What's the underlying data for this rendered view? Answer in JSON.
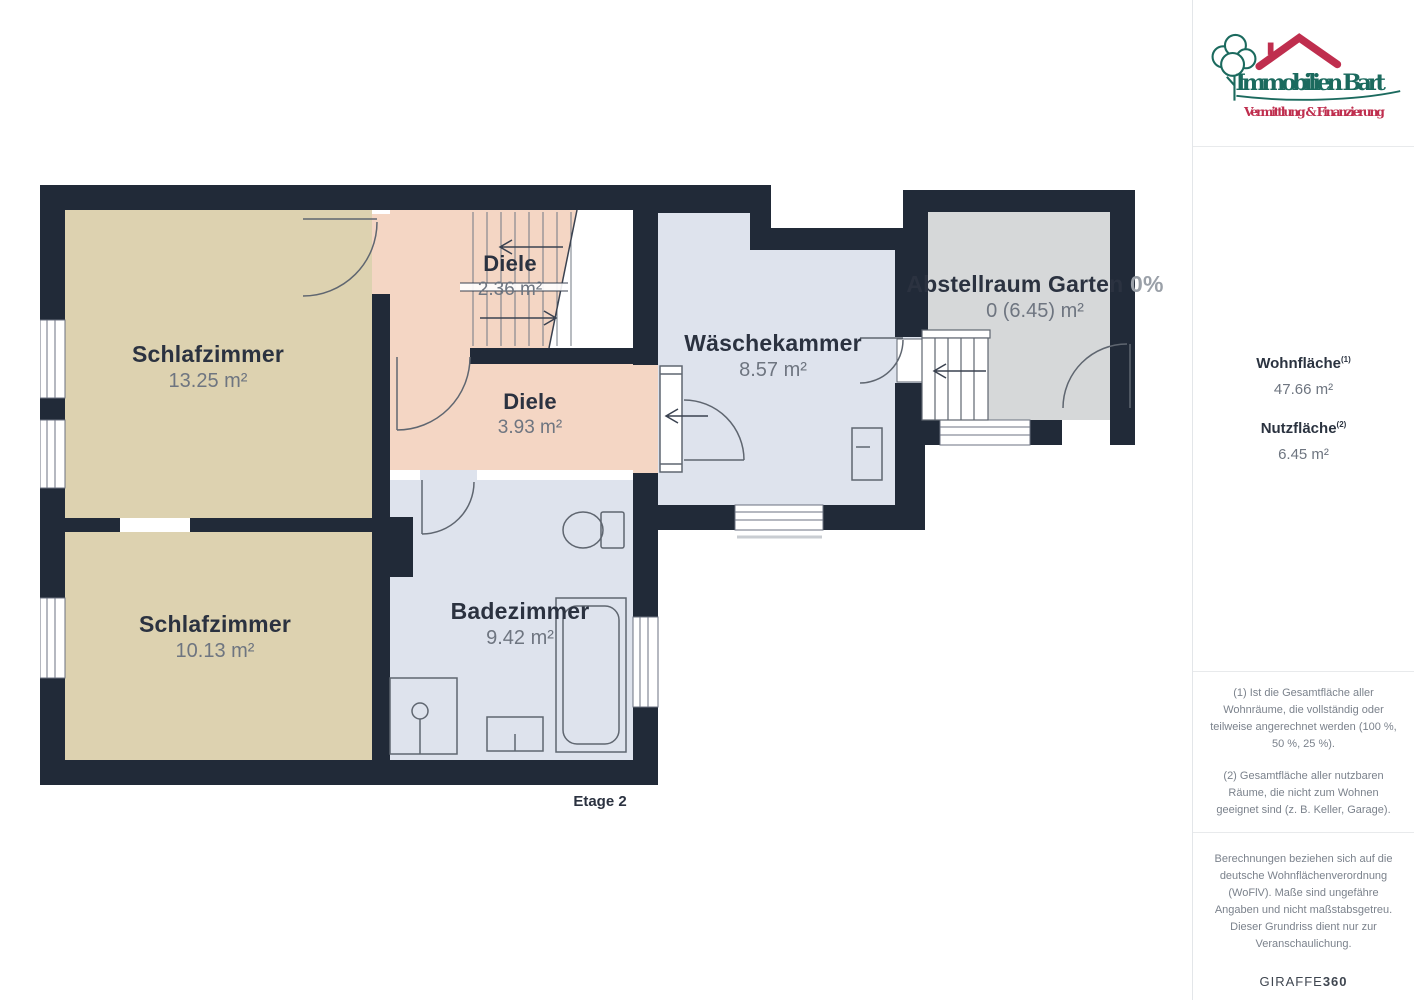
{
  "branding": {
    "title": "Immobilien Bart",
    "subtitle": "Vermittlung & Finanzierung",
    "title_color": "#1b6a5e",
    "subtitle_color": "#bf2e4e"
  },
  "sidebar": {
    "wohnflaeche_label": "Wohnfläche",
    "wohnflaeche_sup": "(1)",
    "wohnflaeche_value": "47.66 m²",
    "nutzflaeche_label": "Nutzfläche",
    "nutzflaeche_sup": "(2)",
    "nutzflaeche_value": "6.45 m²",
    "footnote_1": "(1) Ist die Gesamtfläche aller Wohnräume, die vollständig oder teilweise angerechnet werden (100 %, 50 %, 25 %).",
    "footnote_2": "(2) Gesamtfläche aller nutzbaren Räume, die nicht zum Wohnen geeignet sind (z. B. Keller, Garage).",
    "disclaimer": "Berechnungen beziehen sich auf die deutsche Wohnflächenverordnung (WoFlV). Maße sind ungefähre Angaben und nicht maßstabsgetreu. Dieser Grundriss dient nur zur Veranschaulichung.",
    "brand_name": "GIRAFFE",
    "brand_number": "360"
  },
  "floorplan": {
    "floor_label": "Etage 2",
    "rooms": {
      "schlafzimmer_1": {
        "name": "Schlafzimmer",
        "area": "13.25 m²"
      },
      "diele_1": {
        "name": "Diele",
        "area": "2.36 m²"
      },
      "diele_2": {
        "name": "Diele",
        "area": "3.93 m²"
      },
      "waeschekammer": {
        "name": "Wäschekammer",
        "area": "8.57 m²"
      },
      "abstellraum": {
        "name": "Abstellraum Garten",
        "suffix": "0%",
        "area": "0 (6.45) m²"
      },
      "schlafzimmer_2": {
        "name": "Schlafzimmer",
        "area": "10.13 m²"
      },
      "badezimmer": {
        "name": "Badezimmer",
        "area": "9.42 m²"
      }
    },
    "colors": {
      "wall": "#212a38",
      "bedroom": "#ddd2b0",
      "hallway": "#f4d6c4",
      "bathroom": "#dee3ed",
      "storage": "#d6d8d9"
    }
  }
}
